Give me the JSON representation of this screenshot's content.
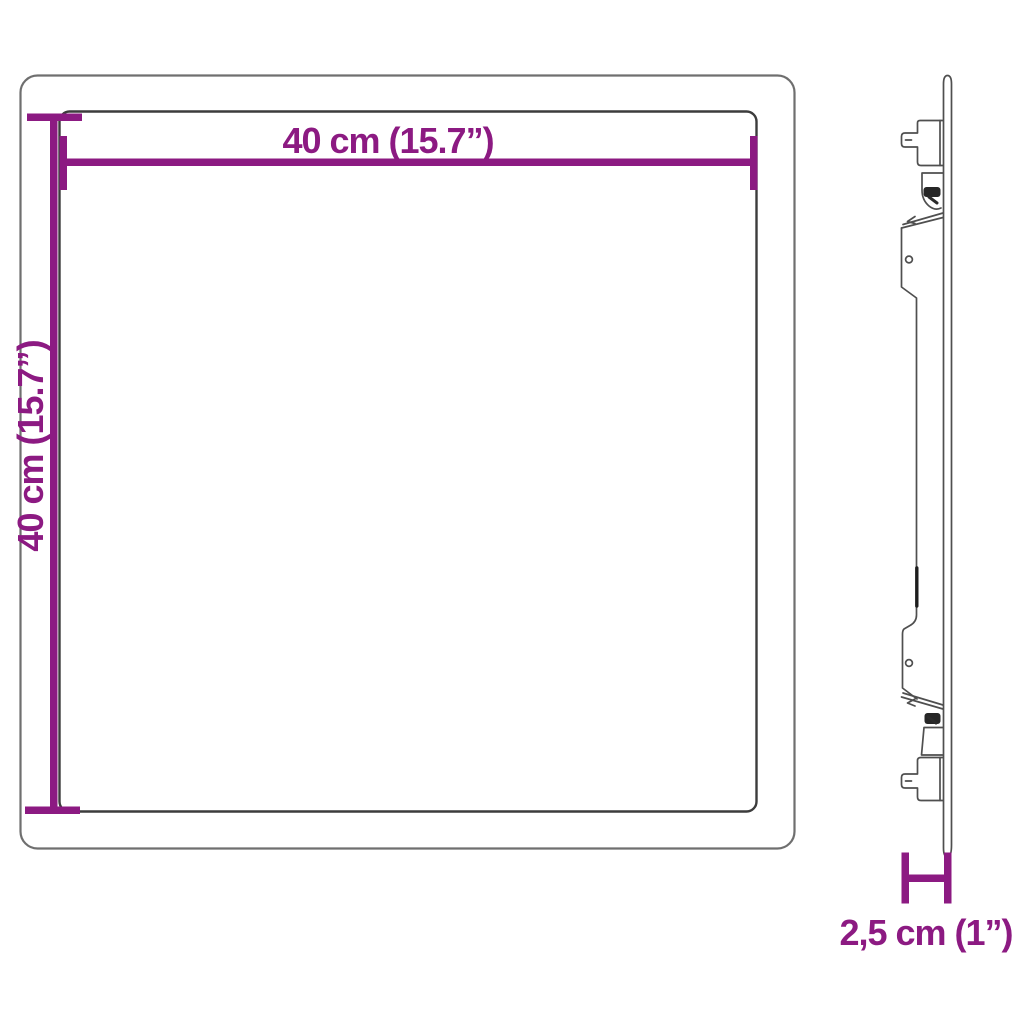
{
  "diagram": {
    "background_color": "#ffffff",
    "accent_color": "#8c1a82",
    "front_outline_outer_color": "#6f6f6f",
    "front_outline_inner_color": "#3c3c3c",
    "side_outline_color": "#4f4f4f",
    "front_view": {
      "width_label": "40 cm (15.7”)",
      "height_label": "40 cm (15.7”)"
    },
    "side_view": {
      "depth_label": "2,5 cm (1”)"
    }
  }
}
